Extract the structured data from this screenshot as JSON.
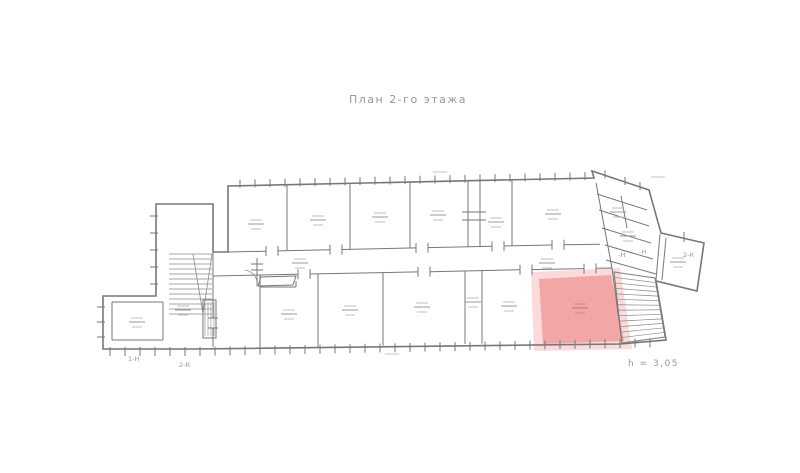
{
  "title": {
    "text": "План 2-го этажа"
  },
  "footer": {
    "height_note": "h = 3,05"
  },
  "annotations": {
    "left_niche": "1-Н",
    "left_duct": "2-К",
    "right_niche_1": "-Н",
    "right_niche_2": "-Н",
    "right_duct": "2-К"
  },
  "highlight": {
    "room_color": "#f2a3a3",
    "halo_color": "#f8c6c6",
    "border_color": "#e27d7d"
  },
  "drawing": {
    "wall_color": "#777777",
    "thin_color": "#8a8a8a",
    "text_color": "#979797"
  }
}
